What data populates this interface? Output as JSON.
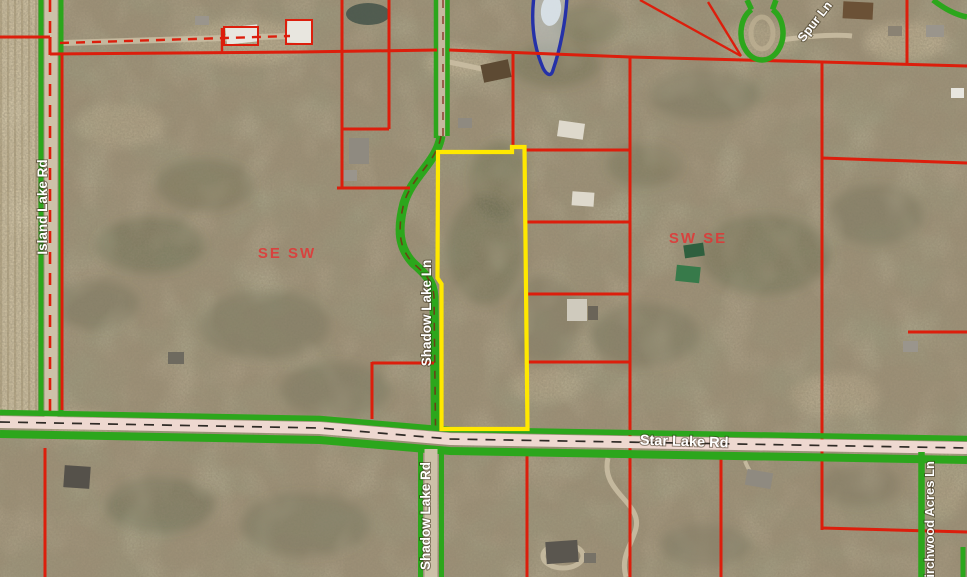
{
  "map": {
    "title": "Aerial parcel map",
    "canvas": {
      "width": 967,
      "height": 577
    },
    "road_labels": [
      {
        "id": "island-lake-rd",
        "text": "Island Lake Rd"
      },
      {
        "id": "shadow-lake-ln",
        "text": "Shadow Lake Ln"
      },
      {
        "id": "shadow-lake-rd",
        "text": "Shadow Lake Rd"
      },
      {
        "id": "star-lake-rd",
        "text": "Star Lake Rd"
      },
      {
        "id": "spur-ln",
        "text": "Spur Ln"
      },
      {
        "id": "birchwood-acres-ln",
        "text": "Birchwood Acres Ln"
      }
    ],
    "section_labels": [
      {
        "text": "SE SW"
      },
      {
        "text": "SW SE"
      }
    ],
    "colors": {
      "parcel_line": "#dc1e0c",
      "road_edge": "#2ca61c",
      "selected_parcel_outline": "#ffe800",
      "water_outline": "#2531a8",
      "section_label": "#e23535",
      "star_lake_roadbed": "#eed8d0",
      "gravel_roadbed": "#cdc1a9"
    }
  }
}
